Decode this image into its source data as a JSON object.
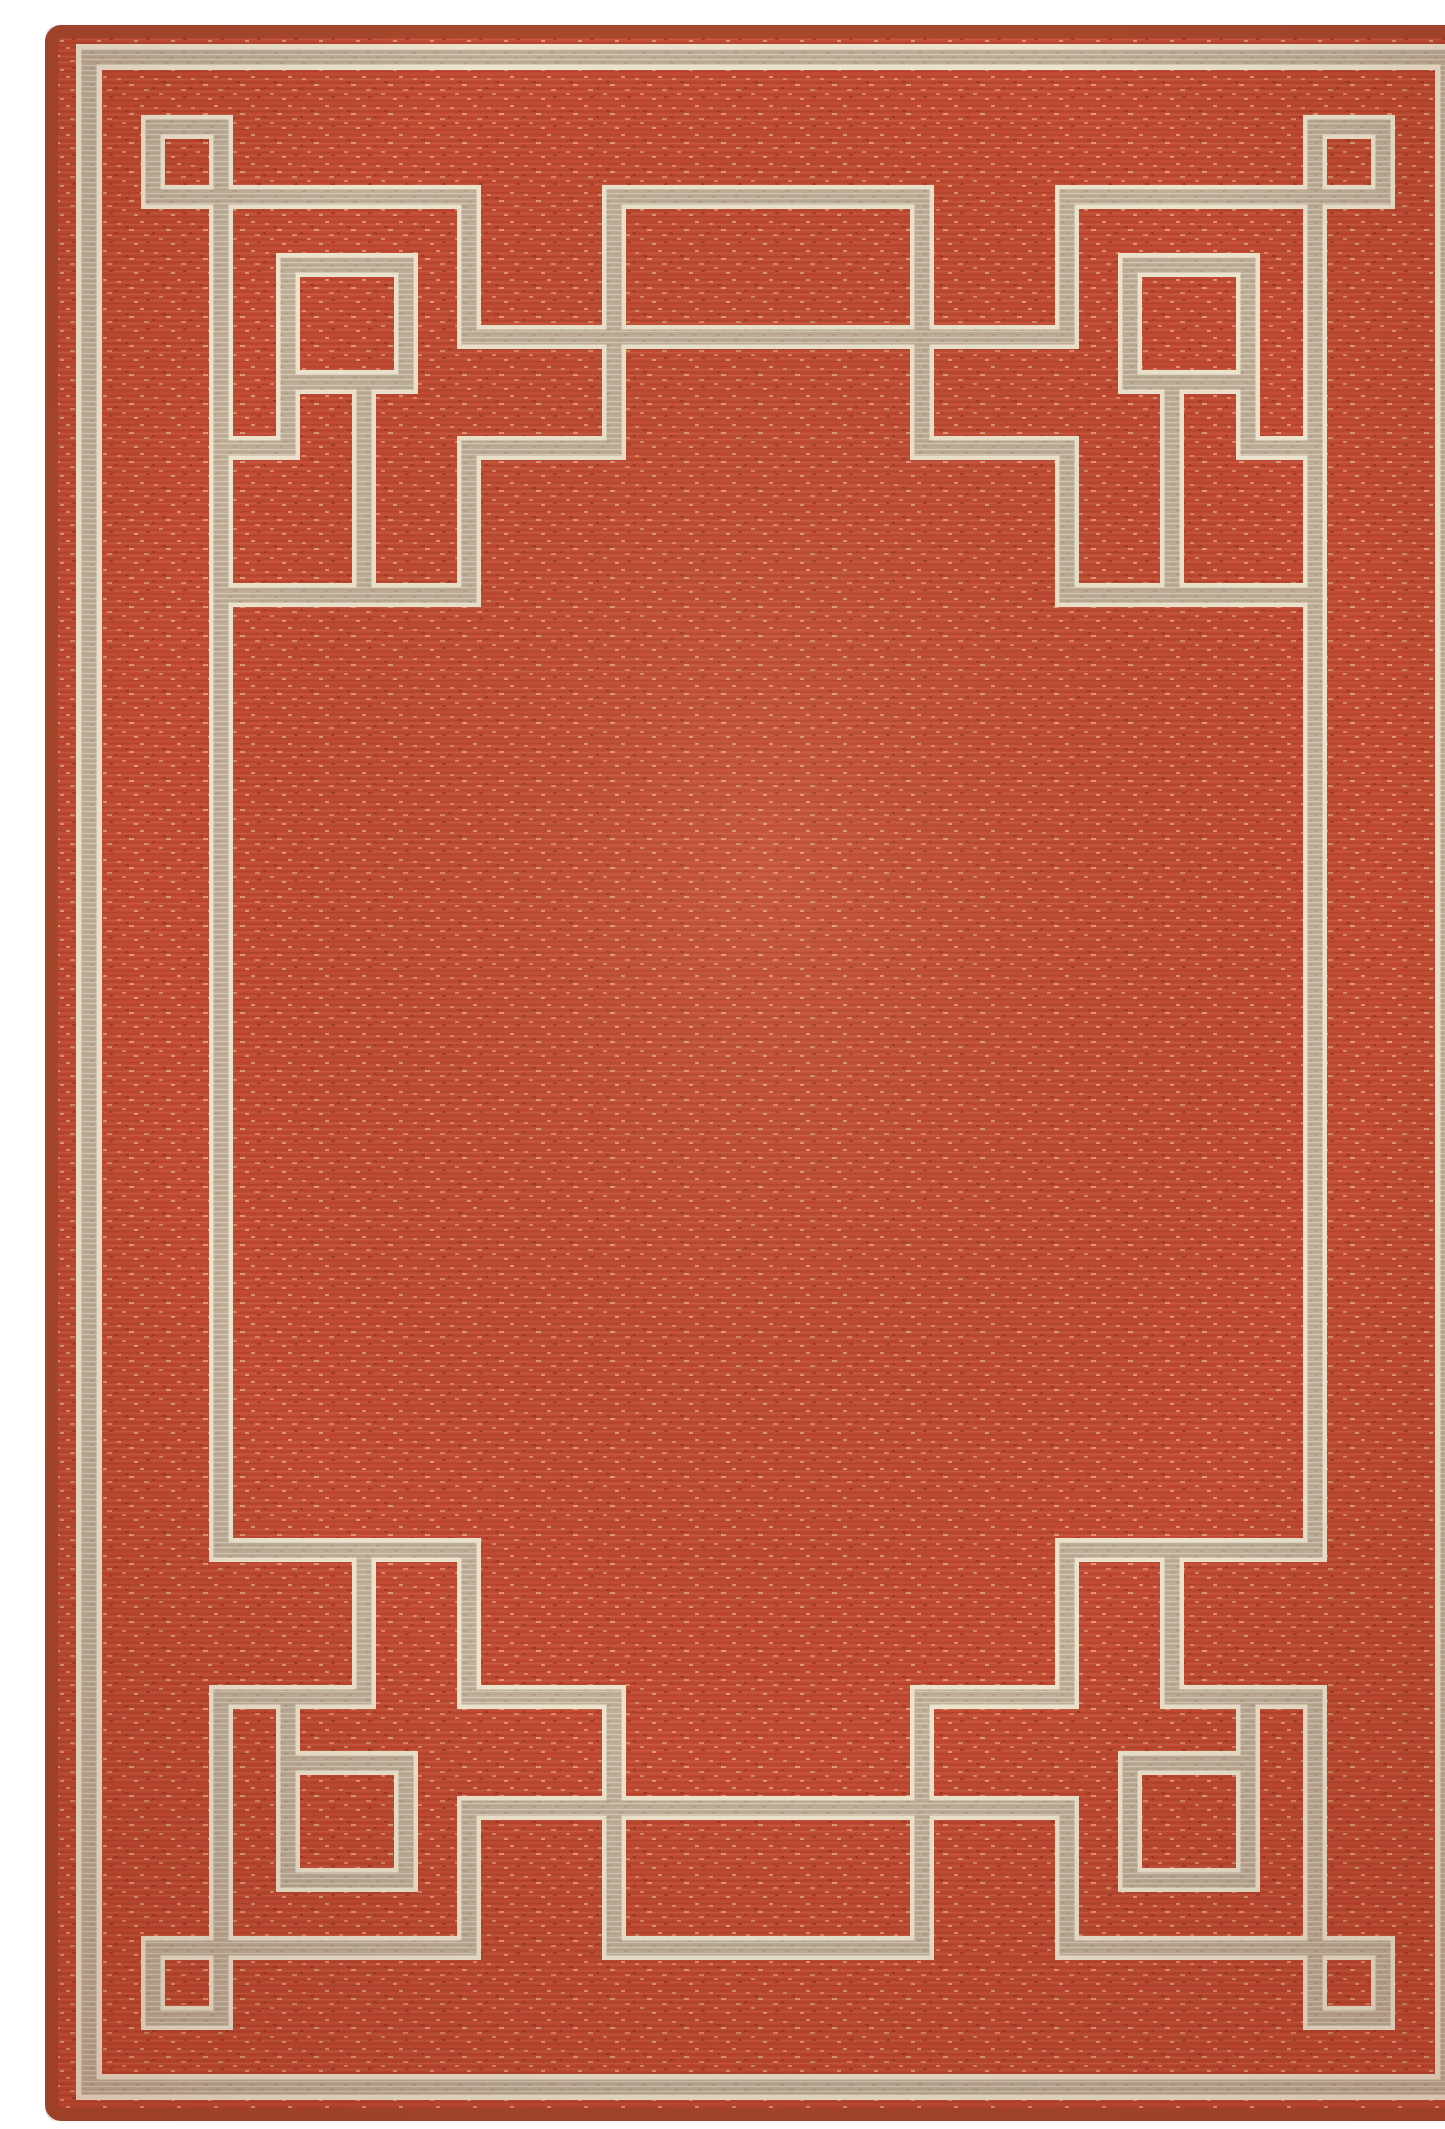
{
  "image": {
    "domain": "natural-image",
    "subject": "area-rug-product-photo",
    "aria_label": "Rectangular terracotta red flat-weave area rug with a tan Greek key fret border, nested square motifs in each corner and a plain red center field, photographed on a white background",
    "content": {
      "rug_shape": "vertical rectangle, slightly rounded corners",
      "pattern": "Greek key / fretwork frame with interlocking square rings",
      "motifs": [
        "thin tan border band with cream edges near rug edge",
        "small square ring in each corner",
        "larger square ring set diagonally inward at each corner",
        "stepped key lines connecting corners along top and bottom",
        "wide rectangle motif centered at top and bottom",
        "long vertical key lines down left and right sides",
        "plain heathered red center field"
      ],
      "background": "white seamless photo backdrop"
    }
  },
  "palette": {
    "background": "#ffffff",
    "field_red": "#c24b33",
    "field_red_dark": "#a93c28",
    "field_red_light": "#d4744f",
    "fleck_light": "#e09a70",
    "fleck_dark": "#8f2e1c",
    "band_tan": "#c1b099",
    "band_tan_dark": "#8d7b63",
    "band_cream": "#ece3cd",
    "selvage": "#a8482d"
  }
}
